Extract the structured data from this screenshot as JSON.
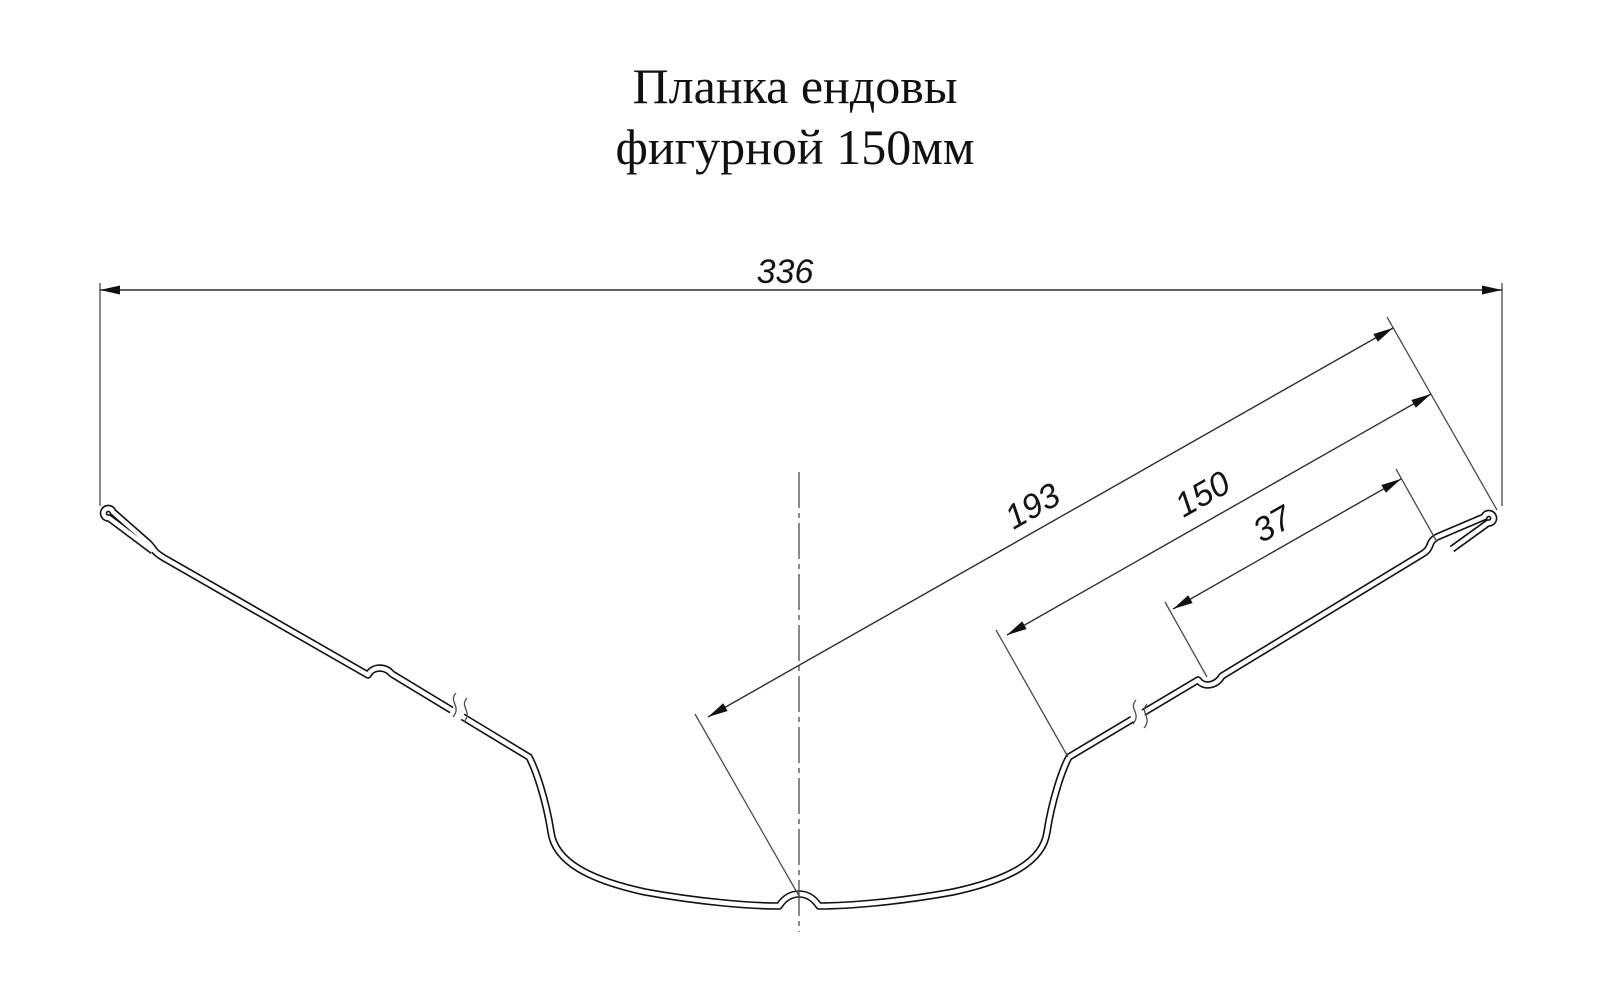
{
  "title": {
    "line1": "Планка ендовы",
    "line2": "фигурной 150мм"
  },
  "dimensions": {
    "overall": {
      "value": "336",
      "description": "overall horizontal width"
    },
    "center_to_edge": {
      "value": "193",
      "description": "valley center to outer edge along flange"
    },
    "flange": {
      "value": "150",
      "description": "flange bend to outer edge"
    },
    "rib_to_edge": {
      "value": "37",
      "description": "stiffening rib to edge step"
    }
  },
  "colors": {
    "background": "#ffffff",
    "line": "#111111",
    "thin_line": "#2e2e2e"
  }
}
